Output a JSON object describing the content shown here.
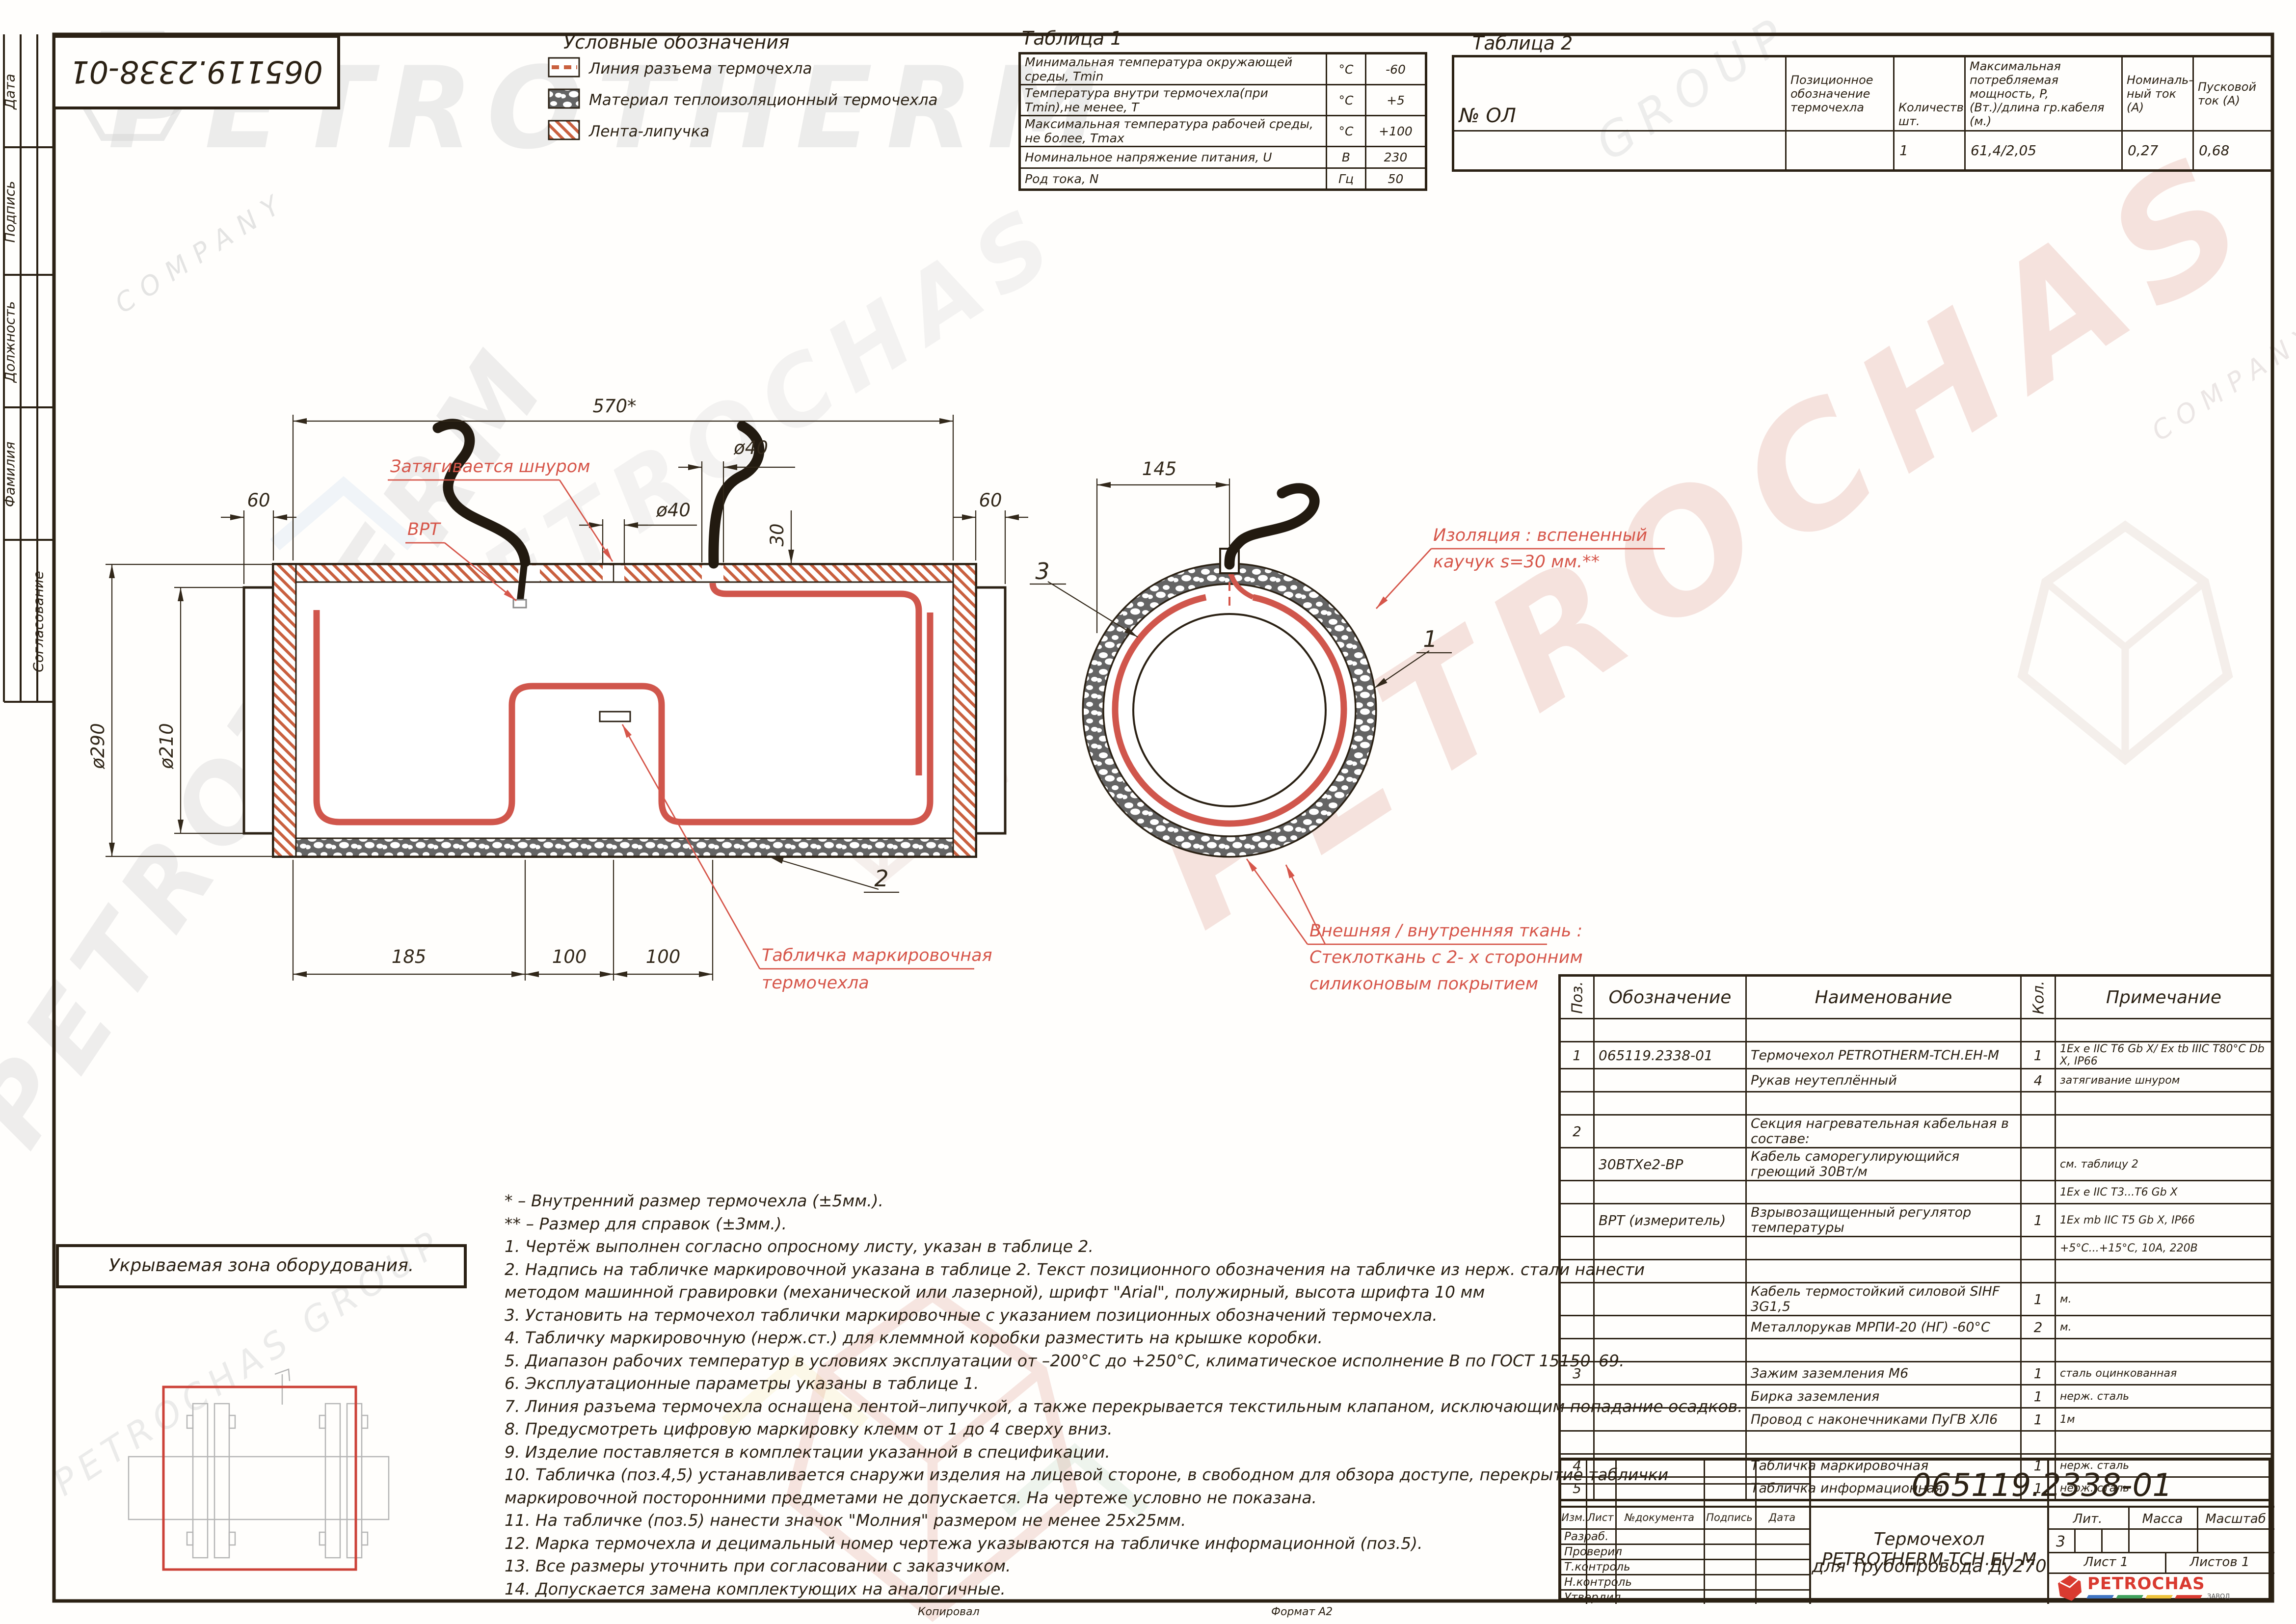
{
  "doc_number": "065119.2338-01",
  "margin_strip": {
    "labels": [
      "Дата",
      "Подпись",
      "Должность",
      "Фамилия",
      "Согласование"
    ]
  },
  "legend": {
    "title": "Условные обозначения",
    "item1": "Линия разъема термочехла",
    "item2": "Материал теплоизоляционный термочехла",
    "item3": "Лента-липучка"
  },
  "table1": {
    "title": "Таблица 1",
    "rows": [
      {
        "param": "Минимальная температура окружающей среды, Tmin",
        "unit": "°С",
        "value": "-60"
      },
      {
        "param": "Температура внутри термочехла(при Tmin),не менее, Т",
        "unit": "°С",
        "value": "+5"
      },
      {
        "param": "Максимальная температура рабочей среды, не более, Tmax",
        "unit": "°С",
        "value": "+100"
      },
      {
        "param": "Номинальное напряжение питания, U",
        "unit": "В",
        "value": "230"
      },
      {
        "param": "Род тока, N",
        "unit": "Гц",
        "value": "50"
      }
    ]
  },
  "table2": {
    "title": "Таблица 2",
    "row_label": "№ ОЛ",
    "headers": {
      "designation": "Позиционное\nобозначение\nтермочехла",
      "qty": "Количество,\nшт.",
      "power": "Максимальная\nпотребляемая мощность, P,\n(Вт.)/длина гр.кабеля (м.)",
      "current": "Номиналь-\nный ток\n(А)",
      "start_current": "Пусковой\nток (А)"
    },
    "values": {
      "qty": "1",
      "power": "61,4/2,05",
      "current": "0,27",
      "start_current": "0,68"
    }
  },
  "dims": {
    "length_top": "570*",
    "collar_left": "60",
    "collar_right": "60",
    "gap_dia": "ø40",
    "hole_dia": "ø40",
    "hole_qty": "2 отв.",
    "hole_offset": "30",
    "d_outer": "ø290",
    "d_collar": "ø210",
    "seg1": "185",
    "seg2": "100",
    "seg3": "100",
    "cs_width": "145"
  },
  "balloons": {
    "pos1": "1",
    "pos2": "2",
    "pos3": "3"
  },
  "annotations": {
    "cord": "Затягивается шнуром",
    "vrt": "ВРТ",
    "plate1": "Табличка маркировочная",
    "plate2": "термочехла",
    "insul1": "Изоляция : вспененный",
    "insul2": "каучук  s=30 мм.**",
    "fabric1": "Внешняя / внутренняя ткань :",
    "fabric2": "Стеклоткань с  2- х сторонним",
    "fabric3": "силиконовым покрытием"
  },
  "zone": {
    "title": "Укрываемая зона оборудования."
  },
  "notes": {
    "lines": [
      "* – Внутренний размер термочехла (±5мм.).",
      "** – Размер для справок (±3мм.).",
      "1. Чертёж выполнен согласно опросному листу, указан в таблице 2.",
      "2. Надпись на табличке маркировочной указана в таблице 2. Текст позиционного обозначения на табличке из нерж. стали нанести",
      "методом машинной гравировки (механической или лазерной), шрифт \"Arial\", полужирный, высота шрифта 10 мм",
      "3. Установить на термочехол таблички маркировочные с указанием позиционных обозначений термочехла.",
      "4. Табличку маркировочную (нерж.ст.) для клеммной коробки разместить на крышке коробки.",
      "5. Диапазон рабочих температур в условиях эксплуатации от –200°С до +250°С, климатическое исполнение В по ГОСТ 15150–69.",
      "6. Эксплуатационные параметры указаны в таблице 1.",
      "7. Линия разъема термочехла оснащена лентой–липучкой, а также перекрывается текстильным клапаном, исключающим попадание осадков.",
      "8. Предусмотреть цифровую маркировку клемм от 1 до 4 сверху вниз.",
      "9. Изделие поставляется в комплектации указанной в спецификации.",
      "10. Табличка (поз.4,5) устанавливается снаружи изделия на лицевой стороне, в свободном для обзора доступе, перекрытие таблички",
      "маркировочной посторонними предметами не допускается. На чертеже условно не показана.",
      "11. На табличке (поз.5) нанести значок \"Молния\" размером не менее 25х25мм.",
      "12. Марка термочехла и децимальный номер чертежа указываются на табличке информационной (поз.5).",
      "13. Все размеры уточнить при согласовании с заказчиком.",
      "14. Допускается замена комплектующих на аналогичные."
    ]
  },
  "spec": {
    "headers": {
      "pos": "Поз.",
      "designation": "Обозначение",
      "name": "Наименование",
      "qty": "Кол.",
      "note": "Примечание"
    },
    "rows": [
      {
        "pos": "",
        "designation": "",
        "name": "",
        "qty": "",
        "note": ""
      },
      {
        "pos": "1",
        "designation": "065119.2338-01",
        "name": "Термочехол PETROTHERM-TCH.EH-М",
        "qty": "1",
        "note": "1Ex e IIC T6 Gb X/ Ex tb IIIC T80°C Db X, IP66"
      },
      {
        "pos": "",
        "designation": "",
        "name": "Рукав неутеплённый",
        "qty": "4",
        "note": "затягивание шнуром"
      },
      {
        "pos": "",
        "designation": "",
        "name": "",
        "qty": "",
        "note": ""
      },
      {
        "pos": "2",
        "designation": "",
        "name": "Секция нагревательная кабельная в составе:",
        "qty": "",
        "note": ""
      },
      {
        "pos": "",
        "designation": "30ВТХе2-ВР",
        "name": "Кабель саморегулирующийся греющий 30Вт/м",
        "qty": "",
        "note": "см. таблицу 2"
      },
      {
        "pos": "",
        "designation": "",
        "name": "",
        "qty": "",
        "note": "1Ex e IIC T3...T6 Gb X"
      },
      {
        "pos": "",
        "designation": "ВРТ (измеритель)",
        "name": "Взрывозащищенный регулятор температуры",
        "qty": "1",
        "note": "1Ex mb IIC T5 Gb X, IP66"
      },
      {
        "pos": "",
        "designation": "",
        "name": "",
        "qty": "",
        "note": "+5°С...+15°С, 10А, 220В"
      },
      {
        "pos": "",
        "designation": "",
        "name": "",
        "qty": "",
        "note": ""
      },
      {
        "pos": "",
        "designation": "",
        "name": "Кабель термостойкий силовой SIHF 3G1,5",
        "qty": "1",
        "note": "м."
      },
      {
        "pos": "",
        "designation": "",
        "name": "Металлорукав МРПИ-20 (НГ) -60°С",
        "qty": "2",
        "note": "м."
      },
      {
        "pos": "",
        "designation": "",
        "name": "",
        "qty": "",
        "note": ""
      },
      {
        "pos": "3",
        "designation": "",
        "name": "Зажим заземления М6",
        "qty": "1",
        "note": "сталь оцинкованная"
      },
      {
        "pos": "",
        "designation": "",
        "name": "Бирка заземления",
        "qty": "1",
        "note": "нерж. сталь"
      },
      {
        "pos": "",
        "designation": "",
        "name": "Провод с наконечниками ПуГВ ХЛ6",
        "qty": "1",
        "note": "1м"
      },
      {
        "pos": "",
        "designation": "",
        "name": "",
        "qty": "",
        "note": ""
      },
      {
        "pos": "4",
        "designation": "",
        "name": "Табличка маркировочная",
        "qty": "1",
        "note": "нерж. сталь"
      },
      {
        "pos": "5",
        "designation": "",
        "name": "Табличка информационная",
        "qty": "1",
        "note": "нерж. сталь"
      }
    ]
  },
  "titleblock": {
    "doc_number": "065119.2338-01",
    "col_izm": "Изм.",
    "col_list": "Лист",
    "col_doc": "№документа",
    "col_sign": "Подпись",
    "col_date": "Дата",
    "row1": "Разраб.",
    "row2": "Проверил",
    "row3": "Т.контроль",
    "row4": "Н.контроль",
    "row5": "Утвердил",
    "title_line1": "Термочехол PETROTHERM-TCH.EH-М",
    "title_line2": "для трубопровода Ду270",
    "lit_label": "Лит.",
    "mass_label": "Масса",
    "scale_label": "Масштаб",
    "lit_value": "3",
    "sheet": "Лист 1",
    "sheets": "Листов 1"
  },
  "logo": {
    "name": "PETROCHAS",
    "sub": "ЗАВОД"
  },
  "footer": {
    "copied": "Копировал",
    "format": "Формат А2"
  },
  "watermarks": {
    "w1": "PETROTHERM",
    "w2": "COMPANY",
    "w3": "PETROCHAS",
    "w4": "GROUP",
    "w5": "Pt",
    "w6": "PETROCHAS GROUP"
  },
  "colors": {
    "line": "#2b2114",
    "annotation_red": "#d6564a",
    "heater_red": "#d0564c",
    "hatch_red": "#c9603f",
    "logo_red": "#d93a30"
  }
}
